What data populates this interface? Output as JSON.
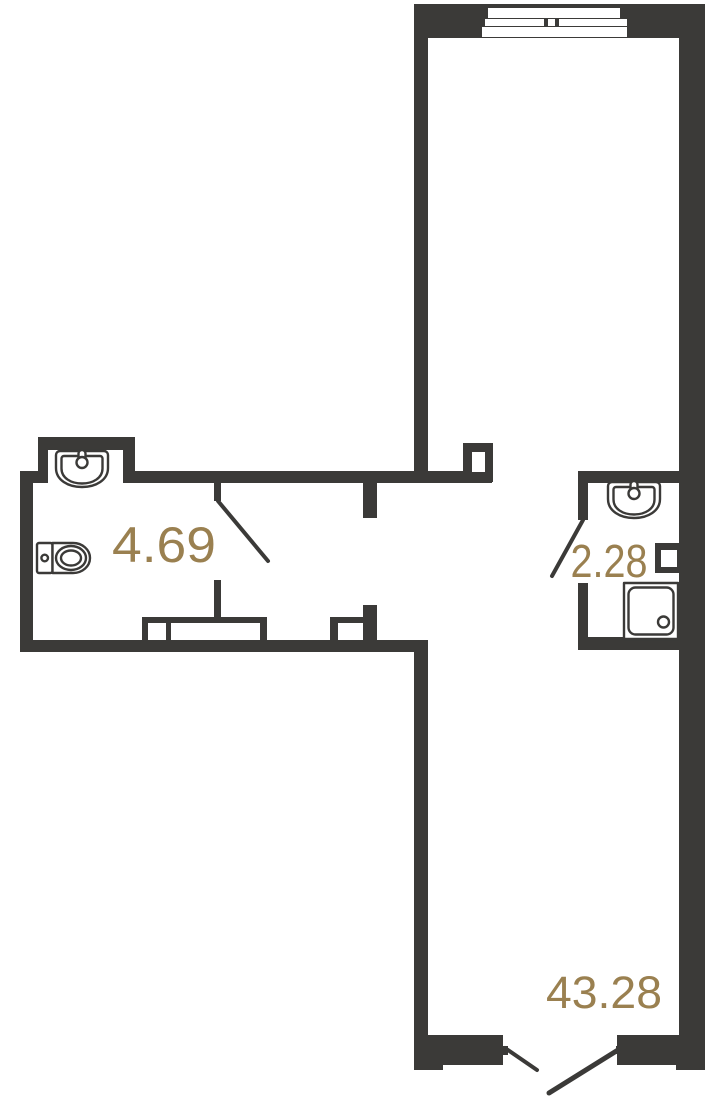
{
  "plan": {
    "type": "apartment-floor-plan",
    "rooms": {
      "bathroom": {
        "area_label": "4.69"
      },
      "shower_room": {
        "area_label": "2.28"
      },
      "living_room": {
        "area_label": "43.28"
      }
    },
    "fixtures": [
      "sink-icon",
      "toilet-icon",
      "sink-icon",
      "shower-tray-icon"
    ],
    "features": [
      "window",
      "door-swing",
      "ventilation-shaft",
      "entrance-double-door"
    ]
  },
  "colors": {
    "wall": "#3b3a38",
    "label": "#9a8050",
    "background": "#ffffff",
    "fixture_fill": "#ffffff"
  }
}
